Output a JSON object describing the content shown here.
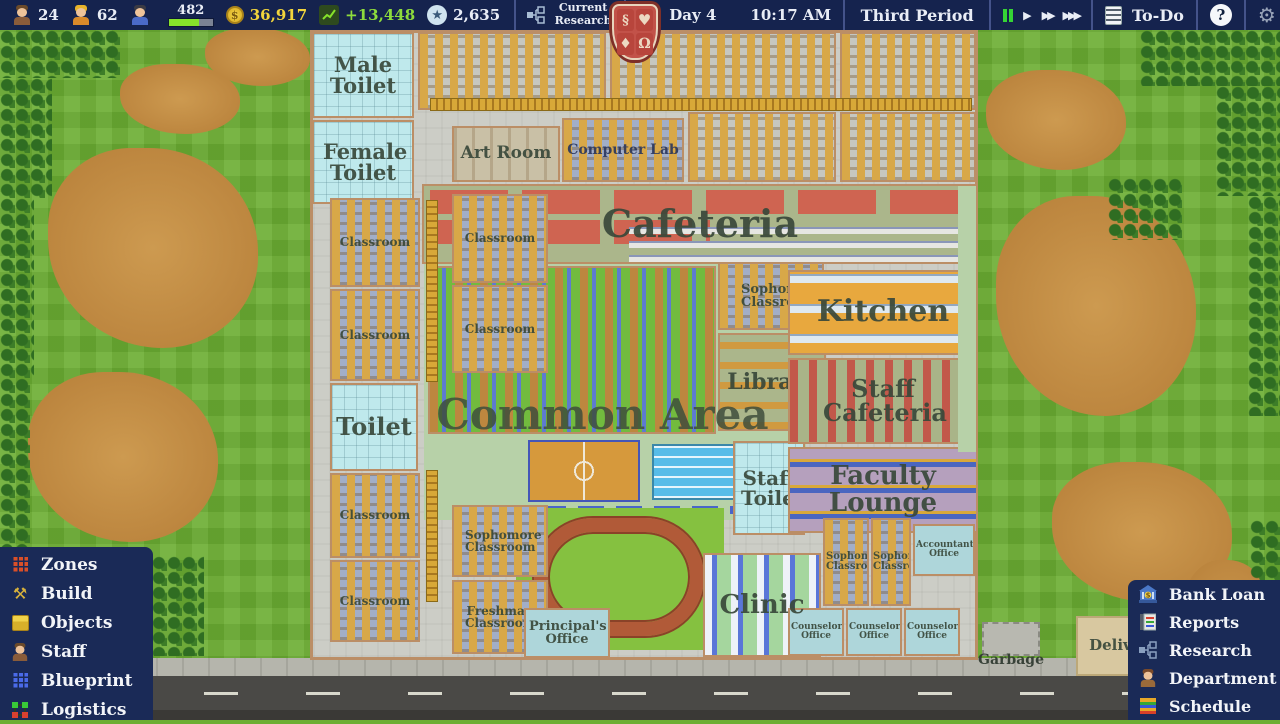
{
  "top_bar": {
    "teachers": "24",
    "workers": "62",
    "students": "482",
    "money": "36,917",
    "income": "+13,448",
    "points": "2,635",
    "research_label": "Current Research",
    "date_year": "Y7",
    "date_day": "Day 4",
    "time": "10:17 AM",
    "period": "Third Period",
    "todo": "To-Do"
  },
  "icons": {
    "dollar": "$",
    "star": "★",
    "play": "▶",
    "ff": "▶▶",
    "fff": "▶▶▶",
    "gear": "⚙",
    "hammer": "⚒",
    "question": "?"
  },
  "crest": {
    "q1": "§",
    "q2": "♥",
    "q3": "♦",
    "q4": "Ω"
  },
  "menu_left": [
    {
      "label": "Zones"
    },
    {
      "label": "Build"
    },
    {
      "label": "Objects"
    },
    {
      "label": "Staff"
    },
    {
      "label": "Blueprint"
    },
    {
      "label": "Logistics"
    }
  ],
  "menu_right": [
    {
      "label": "Bank Loan"
    },
    {
      "label": "Reports"
    },
    {
      "label": "Research"
    },
    {
      "label": "Department"
    },
    {
      "label": "Schedule"
    }
  ],
  "map": {
    "rooms": {
      "male_toilet": "Male Toilet",
      "female_toilet": "Female Toilet",
      "art_room": "Art Room",
      "computer_lab": "Computer Lab",
      "cafeteria": "Cafeteria",
      "common_area": "Common Area",
      "library": "Library",
      "kitchen": "Kitchen",
      "staff_cafeteria": "Staff Cafeteria",
      "faculty_lounge": "Faculty Lounge",
      "staff_toilet": "Staff Toilet",
      "toilet": "Toilet",
      "classroom": "Classroom",
      "sophomore_classroom": "Sophomore Classroom",
      "freshman_classroom": "Freshman Classroom",
      "principals_office": "Principal's Office",
      "clinic": "Clinic",
      "counselors_office": "Counselor's Office",
      "accountants_office": "Accountant's Office",
      "garbage": "Garbage",
      "deliveries": "Deliveries"
    }
  },
  "colors": {
    "panel_navy": "#1a2a57",
    "topbar_navy": "#15234e",
    "money_yellow": "#f2d53c",
    "income_green": "#8edc3c",
    "pause_green": "#35d435",
    "crest_red": "#c25249",
    "grass_green": "#6cae33"
  }
}
